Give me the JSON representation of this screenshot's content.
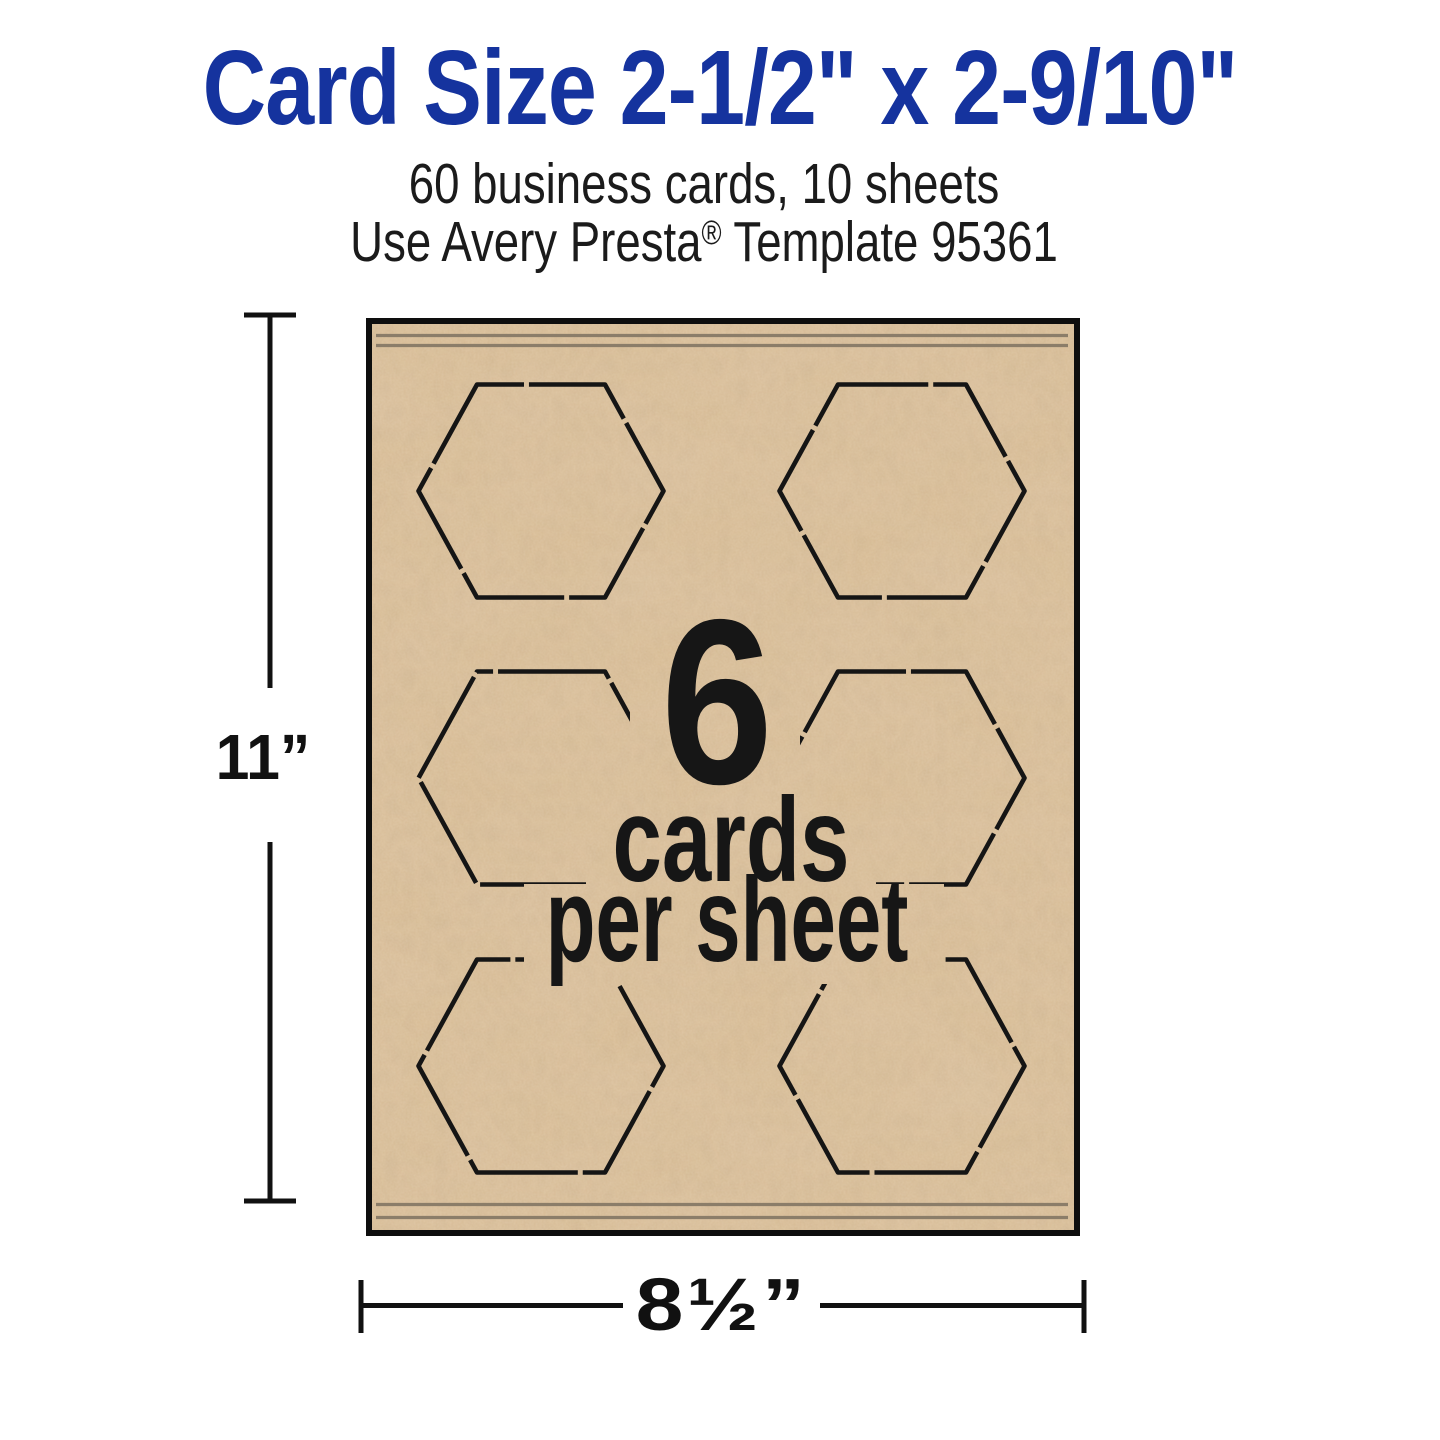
{
  "header": {
    "title": "Card Size 2-1/2\" x 2-9/10\"",
    "subtitle_line1": "60 business cards, 10 sheets",
    "subtitle_line2": {
      "prefix": "Use Avery Presta",
      "registered_mark": "®",
      "suffix": " Template 95361"
    }
  },
  "sheet": {
    "cards_count": "6",
    "caption_line1": "cards",
    "caption_line2": "per sheet"
  },
  "dimensions": {
    "height_label": "11”",
    "width_label": "8½”"
  },
  "colors": {
    "title_blue": "#15339E",
    "paper_kraft": "#d8bb93",
    "rule_line_gray": "#8b7d69",
    "ink_black": "#161616",
    "background": "#ffffff"
  }
}
